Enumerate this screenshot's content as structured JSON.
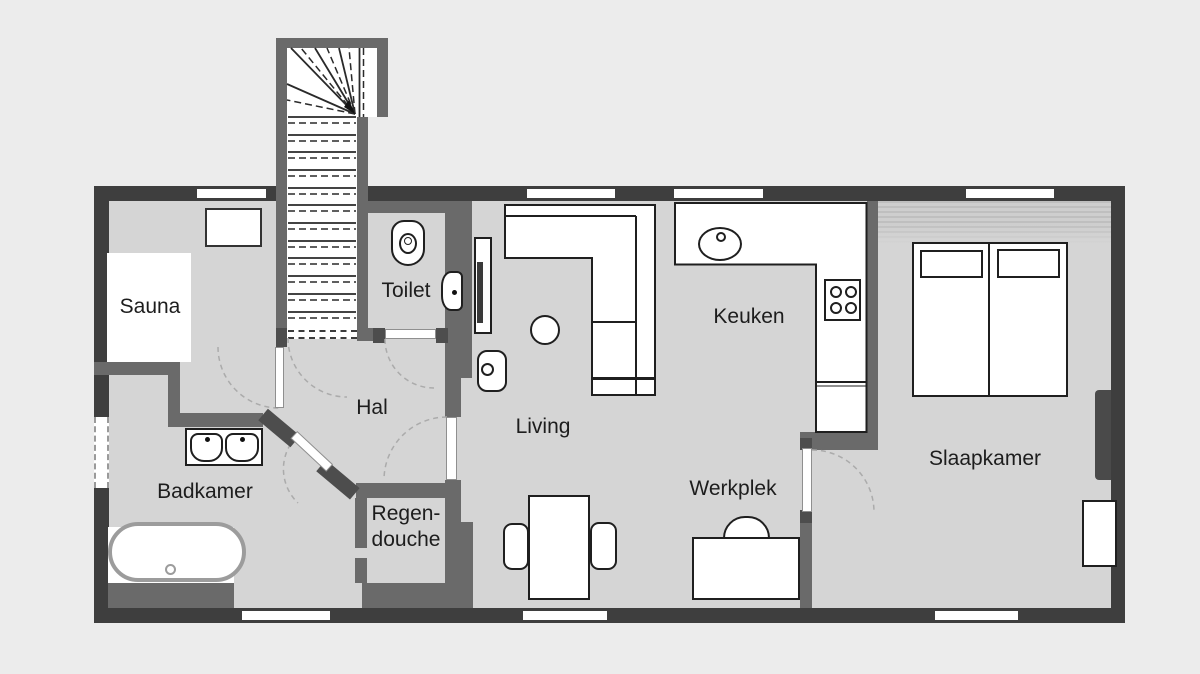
{
  "title": "Floor plan (ground floor)",
  "rooms": {
    "sauna": {
      "label": "Sauna"
    },
    "toilet": {
      "label": "Toilet"
    },
    "hal": {
      "label": "Hal"
    },
    "badkamer": {
      "label": "Badkamer"
    },
    "regendouche": {
      "label_line1": "Regen-",
      "label_line2": "douche"
    },
    "living": {
      "label": "Living"
    },
    "keuken": {
      "label": "Keuken"
    },
    "werkplek": {
      "label": "Werkplek"
    },
    "slaapkamer": {
      "label": "Slaapkamer"
    }
  },
  "fixtures": [
    "staircase",
    "toilet-bowl",
    "hand-basin",
    "tv",
    "armchair",
    "side-table",
    "corner-sofa",
    "kitchen-counter",
    "kitchen-sink",
    "cooktop",
    "dining-table",
    "dining-chair",
    "desk",
    "desk-chair",
    "double-bed",
    "pillows",
    "nightstand",
    "wardrobe",
    "double-sink-unit",
    "bathtub",
    "sauna-cabin",
    "cabinet",
    "utility-block"
  ],
  "colors": {
    "outer_wall": "#3e3e3e",
    "inner_wall": "#6a6a6a",
    "door_post": "#4d4d4d",
    "floor": "#d5d5d5",
    "background": "#ececec",
    "outline": "#1f1f1f",
    "label": "#1d1d1d",
    "tub_rim": "#9c9c9c",
    "arc": "#ababab"
  }
}
